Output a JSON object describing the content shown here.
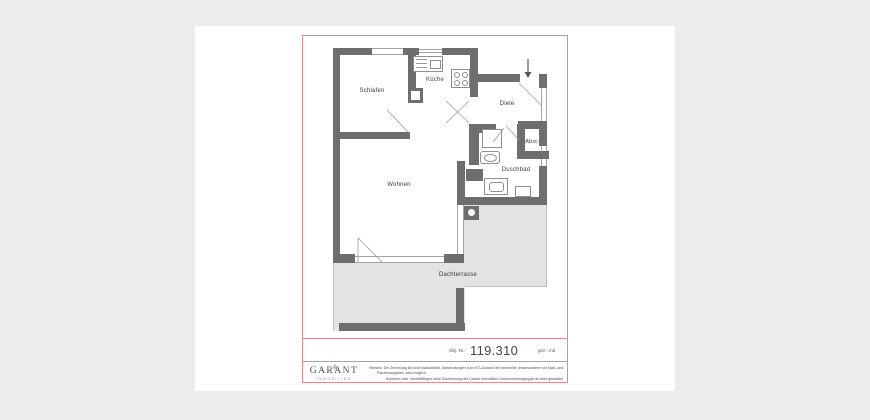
{
  "page": {
    "background_color": "#ececec",
    "paper_color": "#ffffff",
    "frame_color": "#d79090",
    "wall_color": "#6e6e6e",
    "terrace_color": "#e3e3e3"
  },
  "plan": {
    "rooms": [
      {
        "id": "schlafen",
        "label": "Schlafen"
      },
      {
        "id": "kueche",
        "label": "Küche"
      },
      {
        "id": "diele",
        "label": "Diele"
      },
      {
        "id": "abst",
        "label": "Abst."
      },
      {
        "id": "duschbad",
        "label": "Duschbad"
      },
      {
        "id": "wohnen",
        "label": "Wohnen"
      },
      {
        "id": "dachterrasse",
        "label": "Dachterrasse"
      }
    ],
    "symbols": [
      "entrance-arrow",
      "kitchen-sink",
      "stove",
      "shower",
      "washbasin",
      "toilet",
      "washer",
      "column",
      "shaft"
    ]
  },
  "title_block": {
    "obj_label": "Obj.-Nr.:",
    "obj_value": "119.310",
    "drawn_by": "gez.: md"
  },
  "footer": {
    "logo_text": "GARANT",
    "logo_subtext": "IMMOBILIEN",
    "disclaimer_lines": [
      "Hinweis: Die Zeichnung ist nicht maßstäblich. Abweichungen zum IST-Zustand der Immobilie, insbesondere von Maß- und",
      "Flächenangaben, sind möglich.",
      "Kopieren oder Vervielfältigen ohne Zustimmung der Garant Immobilien Unternehmensgruppe ist nicht gestattet!"
    ]
  }
}
